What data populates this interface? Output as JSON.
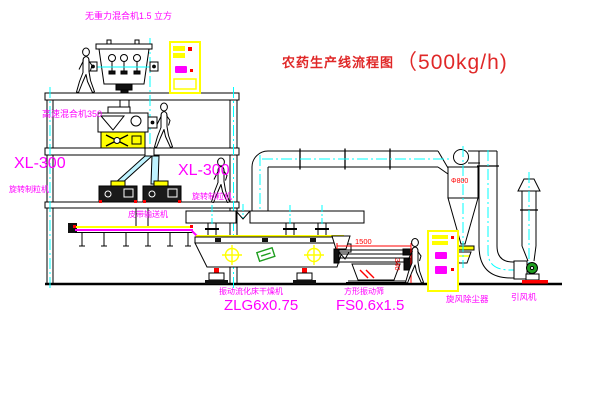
{
  "title": {
    "text_cn": "农药生产线流程图",
    "capacity": "（500kg/h)"
  },
  "labels": {
    "gravity_mixer": "无重力混合机1.5 立方",
    "high_speed_mixer": "高速混合机350",
    "granulator_left_model": "XL-300",
    "granulator_left_name": "旋转制粒机",
    "granulator_right_model": "XL-300",
    "granulator_right_name": "旋转制粒机",
    "belt_conveyor": "皮带输送机",
    "dryer_name": "振动流化床干燥机",
    "dryer_model": "ZLG6x0.75",
    "screen_name": "方形振动筛",
    "screen_model": "FS0.6x1.5",
    "cyclone": "旋风除尘器",
    "fan": "引风机"
  },
  "dimensions": {
    "screen_length": "1500",
    "screen_height": "340",
    "cyclone_diameter": "Φ800"
  },
  "colors": {
    "label_magenta": "#ff00ff",
    "title_red": "#e02828",
    "dimension_red": "#ff0000",
    "centerline_cyan": "#00ffff",
    "equipment_yellow": "#ffff00",
    "motor_green": "#1f9e1f",
    "line_black": "#000000"
  }
}
